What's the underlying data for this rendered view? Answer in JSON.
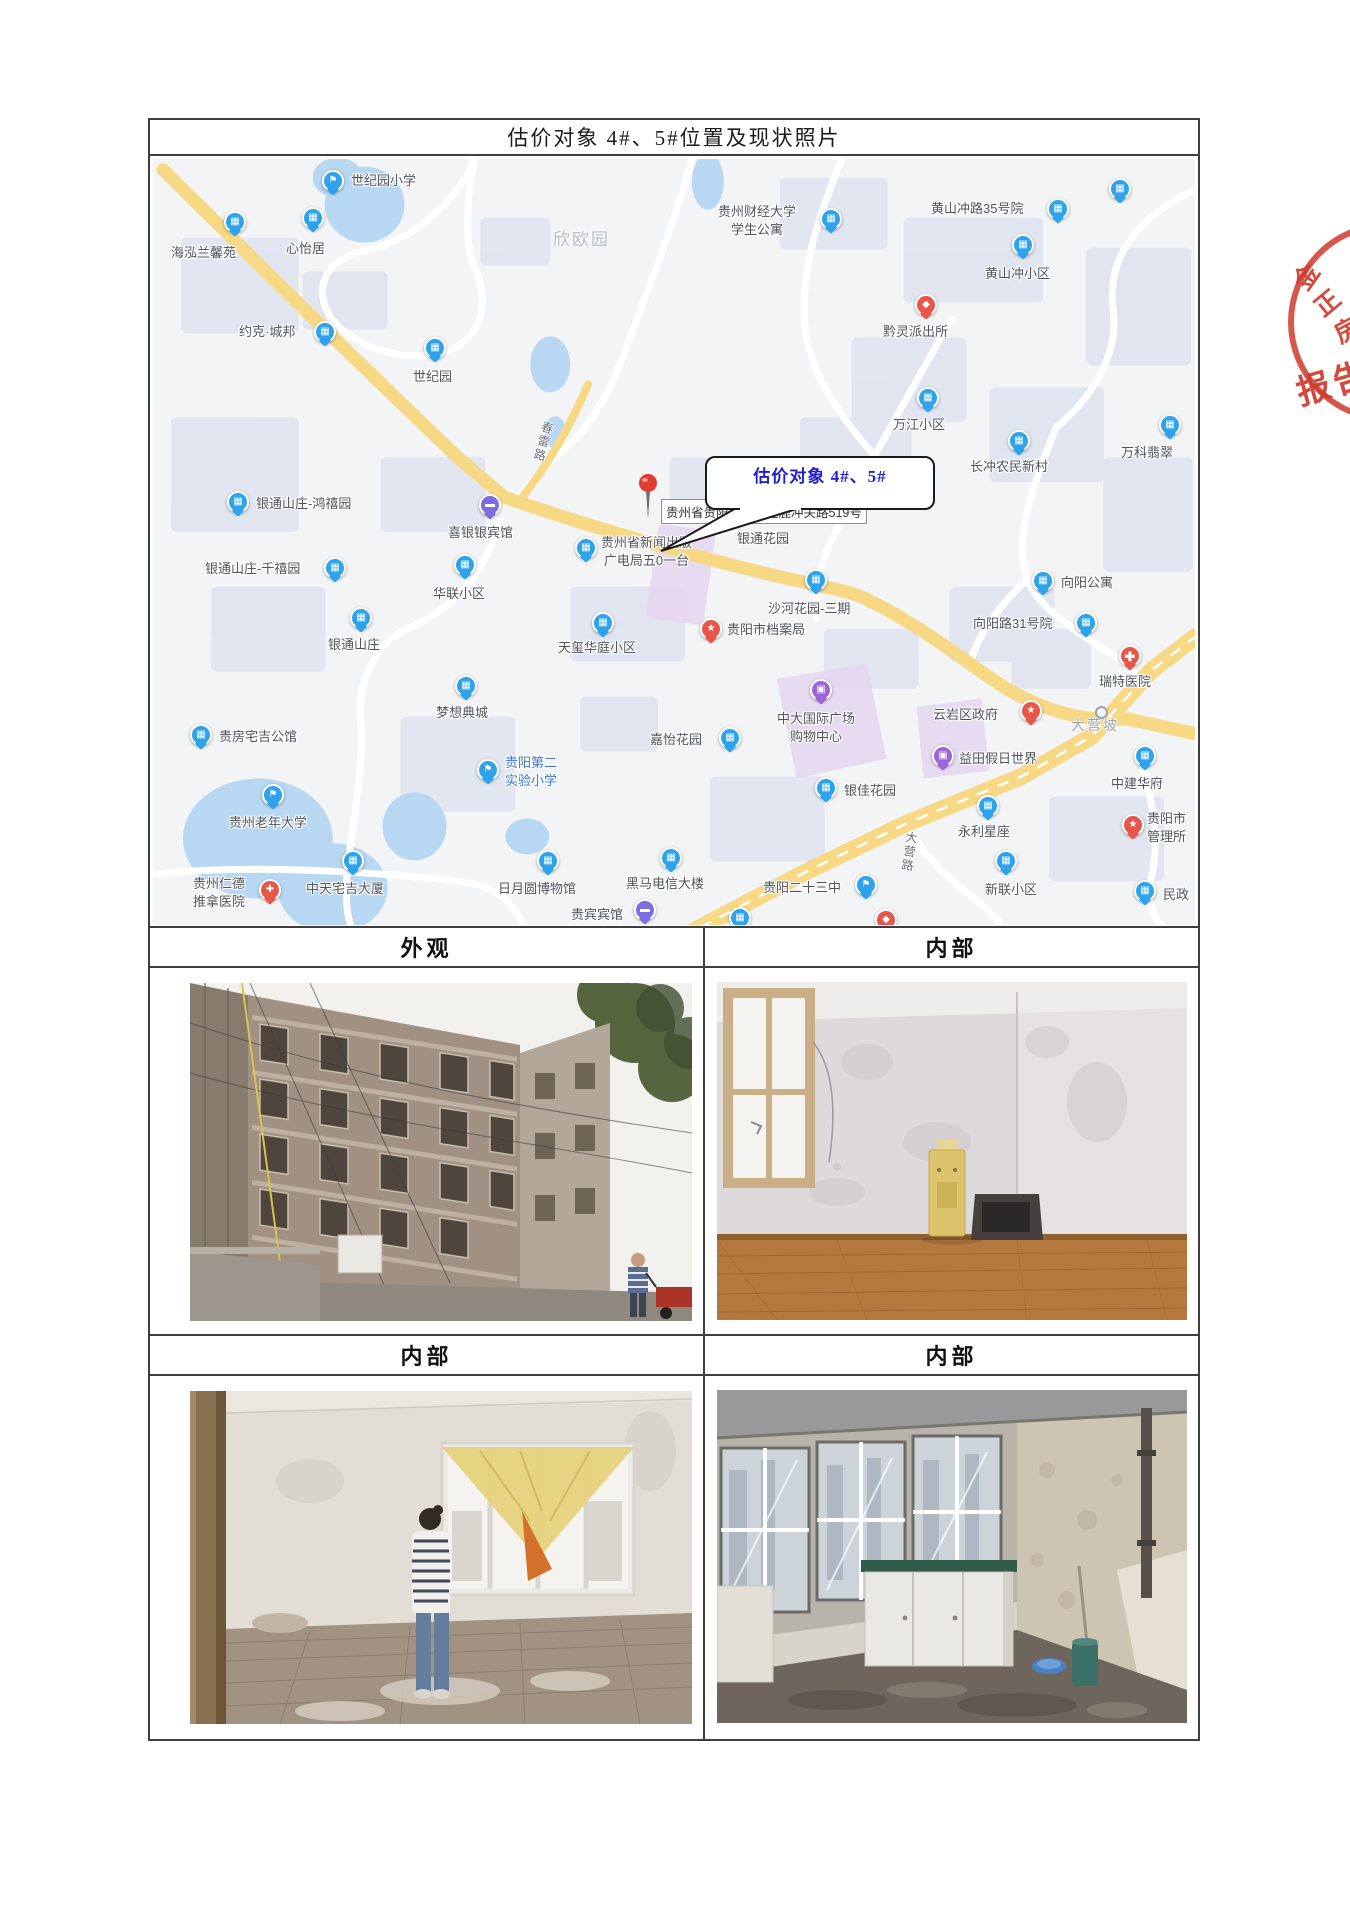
{
  "page": {
    "title": "估价对象 4#、5#位置及现状照片"
  },
  "colors": {
    "pin_blue": "#2ea3ec",
    "pin_hotel_purple": "#7d6ee0",
    "pin_shopping_purple": "#9d64d8",
    "pin_red": "#e8564a",
    "road_yellow": "#f7d884",
    "water_blue": "#b7d7f3",
    "area_purple": "#e6d6f0",
    "map_bg": "#f3f4f6",
    "label_gray": "#4f545c",
    "stamp_red": "#cf3b2e",
    "callout_blue": "#2020c8"
  },
  "map": {
    "callout": {
      "text": "估价对象 4#、5#"
    },
    "destination": {
      "address": "贵州省贵阳市云岩区鹿冲关路519号"
    },
    "text_labels": [
      {
        "text": "欣欧园",
        "x": 400,
        "y": 66,
        "size": 17,
        "color": "#b3bac6"
      },
      {
        "text": "大营坡",
        "x": 918,
        "y": 556,
        "size": 14,
        "color": "#9aa3ae"
      },
      {
        "text": "春雷路",
        "x": 382,
        "y": 262,
        "size": 12,
        "color": "#6b7078",
        "vertical": true,
        "rotate": 15
      },
      {
        "text": "大营路",
        "x": 748,
        "y": 672,
        "size": 12,
        "color": "#6b7078",
        "vertical": true,
        "rotate": 8
      }
    ],
    "pois": [
      {
        "name": "世纪园小学",
        "type": "school",
        "pin": [
          180,
          22
        ],
        "label": [
          198,
          13
        ]
      },
      {
        "name": "海泓兰馨苑",
        "type": "building",
        "pin": [
          82,
          63
        ],
        "label": [
          18,
          85
        ]
      },
      {
        "name": "心怡居",
        "type": "building",
        "pin": [
          160,
          59
        ],
        "label": [
          133,
          81
        ]
      },
      {
        "name": "约克·城邦",
        "type": "building",
        "pin": [
          172,
          173
        ],
        "label": [
          86,
          164
        ]
      },
      {
        "name": "世纪园",
        "type": "building",
        "pin": [
          282,
          189
        ],
        "label": [
          260,
          209
        ]
      },
      {
        "name": "贵州财经大学学生公寓",
        "lines": [
          "贵州财经大学",
          "学生公寓"
        ],
        "type": "building",
        "pin": [
          678,
          60
        ],
        "label": [
          565,
          44
        ]
      },
      {
        "name": "黄山冲路35号院",
        "type": "building",
        "pin": [
          905,
          50
        ],
        "label": [
          778,
          41
        ]
      },
      {
        "name": "黄山冲小区",
        "type": "building",
        "pin": [
          870,
          86
        ],
        "label": [
          832,
          106
        ]
      },
      {
        "name": "黔灵派出所",
        "type": "police",
        "pin": [
          773,
          146
        ],
        "label": [
          730,
          164
        ]
      },
      {
        "name": "万江小区",
        "type": "building",
        "pin": [
          775,
          239
        ],
        "label": [
          740,
          257
        ]
      },
      {
        "name": "长冲农民新村",
        "type": "building",
        "pin": [
          866,
          282
        ],
        "label": [
          817,
          299
        ]
      },
      {
        "name": "万科翡翠",
        "type": "building",
        "pin": [
          1017,
          266
        ],
        "label": [
          968,
          285
        ]
      },
      {
        "name": "向阳公寓",
        "type": "building",
        "pin": [
          890,
          422
        ],
        "label": [
          908,
          415
        ]
      },
      {
        "name": "向阳路31号院",
        "type": "building",
        "pin": [
          933,
          464
        ],
        "label": [
          820,
          456
        ]
      },
      {
        "name": "瑞特医院",
        "type": "cross",
        "pin": [
          977,
          497
        ],
        "label": [
          946,
          514
        ]
      },
      {
        "name": "喜银银宾馆",
        "type": "hotel",
        "pin": [
          337,
          346
        ],
        "label": [
          295,
          365
        ]
      },
      {
        "name": "银通山庄-鸿禧园",
        "type": "building",
        "pin": [
          85,
          343
        ],
        "label": [
          103,
          336
        ]
      },
      {
        "name": "银通山庄-千禧园",
        "type": "building",
        "pin": [
          182,
          409
        ],
        "label": [
          52,
          401
        ]
      },
      {
        "name": "华联小区",
        "type": "building",
        "pin": [
          312,
          406
        ],
        "label": [
          280,
          426
        ]
      },
      {
        "name": "贵州省新闻出版广电局五0一台",
        "lines": [
          "贵州省新闻出版",
          "广电局五0一台"
        ],
        "type": "building",
        "pin": [
          433,
          389
        ],
        "label": [
          448,
          375
        ]
      },
      {
        "name": "银通花园",
        "type": "building",
        "pin": [
          617,
          349
        ],
        "label": [
          584,
          371
        ]
      },
      {
        "name": "沙河花园-三期",
        "type": "building",
        "pin": [
          663,
          421
        ],
        "label": [
          615,
          441
        ]
      },
      {
        "name": "天玺华庭小区",
        "type": "building",
        "pin": [
          450,
          464
        ],
        "label": [
          405,
          480
        ]
      },
      {
        "name": "贵阳市档案局",
        "type": "star",
        "pin": [
          558,
          470
        ],
        "label": [
          574,
          462
        ]
      },
      {
        "name": "银通山庄",
        "type": "building",
        "pin": [
          208,
          459
        ],
        "label": [
          175,
          477
        ]
      },
      {
        "name": "梦想典城",
        "type": "building",
        "pin": [
          313,
          527
        ],
        "label": [
          283,
          545
        ]
      },
      {
        "name": "贵房宅吉公馆",
        "type": "building",
        "pin": [
          48,
          576
        ],
        "label": [
          66,
          569
        ]
      },
      {
        "name": "贵阳第二实验小学",
        "lines": [
          "贵阳第二",
          "实验小学"
        ],
        "type": "school",
        "pin": [
          335,
          611
        ],
        "label": [
          352,
          595
        ],
        "label_color": "#3d77c9"
      },
      {
        "name": "贵州老年大学",
        "type": "school",
        "pin": [
          120,
          636
        ],
        "label": [
          76,
          655
        ]
      },
      {
        "name": "贵州仁德推拿医院",
        "lines": [
          "贵州仁德",
          "推拿医院"
        ],
        "type": "hospital",
        "pin": [
          117,
          731
        ],
        "label": [
          40,
          716
        ]
      },
      {
        "name": "中天宅吉大厦",
        "type": "building",
        "pin": [
          200,
          702
        ],
        "label": [
          153,
          721
        ]
      },
      {
        "name": "日月圆博物馆",
        "type": "building",
        "pin": [
          395,
          702
        ],
        "label": [
          345,
          721
        ]
      },
      {
        "name": "贵宾宾馆",
        "type": "hotel",
        "pin": [
          492,
          751
        ],
        "label": [
          418,
          747
        ]
      },
      {
        "name": "黑马电信大楼",
        "type": "building",
        "pin": [
          518,
          699
        ],
        "label": [
          473,
          716
        ]
      },
      {
        "name": "嘉怡花园",
        "type": "building",
        "pin": [
          577,
          579
        ],
        "label": [
          497,
          572
        ]
      },
      {
        "name": "中大国际广场购物中心",
        "lines": [
          "中大国际广场",
          "购物中心"
        ],
        "type": "shopping",
        "pin": [
          668,
          531
        ],
        "label": [
          624,
          551
        ]
      },
      {
        "name": "云岩区政府",
        "type": "star",
        "pin": [
          878,
          552
        ],
        "label": [
          780,
          547
        ]
      },
      {
        "name": "益田假日世界",
        "type": "shopping",
        "pin": [
          790,
          597
        ],
        "label": [
          806,
          591
        ]
      },
      {
        "name": "银佳花园",
        "type": "building",
        "pin": [
          673,
          629
        ],
        "label": [
          691,
          623
        ]
      },
      {
        "name": "永利星座",
        "type": "building",
        "pin": [
          835,
          647
        ],
        "label": [
          805,
          664
        ]
      },
      {
        "name": "贵阳二十三中",
        "type": "school",
        "pin": [
          713,
          726
        ],
        "label": [
          610,
          720
        ]
      },
      {
        "name": "新联小区",
        "type": "building",
        "pin": [
          853,
          702
        ],
        "label": [
          832,
          722
        ]
      },
      {
        "name": "中建华府",
        "type": "building",
        "pin": [
          992,
          597
        ],
        "label": [
          958,
          616
        ]
      },
      {
        "name": "贵阳市管理所",
        "lines": [
          "贵阳市",
          "管理所"
        ],
        "type": "star",
        "pin": [
          980,
          666
        ],
        "label": [
          994,
          651
        ]
      },
      {
        "name": "民政",
        "type": "building",
        "pin": [
          992,
          732
        ],
        "label": [
          1010,
          727
        ]
      },
      {
        "name": "",
        "type": "building",
        "pin": [
          967,
          30
        ]
      },
      {
        "name": "",
        "type": "building",
        "pin": [
          587,
          759
        ]
      },
      {
        "name": "",
        "type": "police",
        "pin": [
          733,
          761
        ]
      }
    ]
  },
  "sections": [
    {
      "header": "外观",
      "photo_alt": "老旧多层住宅外立面（仰视拍摄）"
    },
    {
      "header": "内部",
      "photo_alt": "房间内部：木地板、饮水机与旧电视"
    },
    {
      "header": "内部",
      "photo_alt": "房间内部：人站在挂黄色帘布的窗前"
    },
    {
      "header": "内部",
      "photo_alt": "房间内部：大窗、白色柜子、水桶与拖把"
    }
  ],
  "stamp": {
    "arc_chars": [
      "金",
      "正",
      "房"
    ],
    "center_text": "报告"
  }
}
